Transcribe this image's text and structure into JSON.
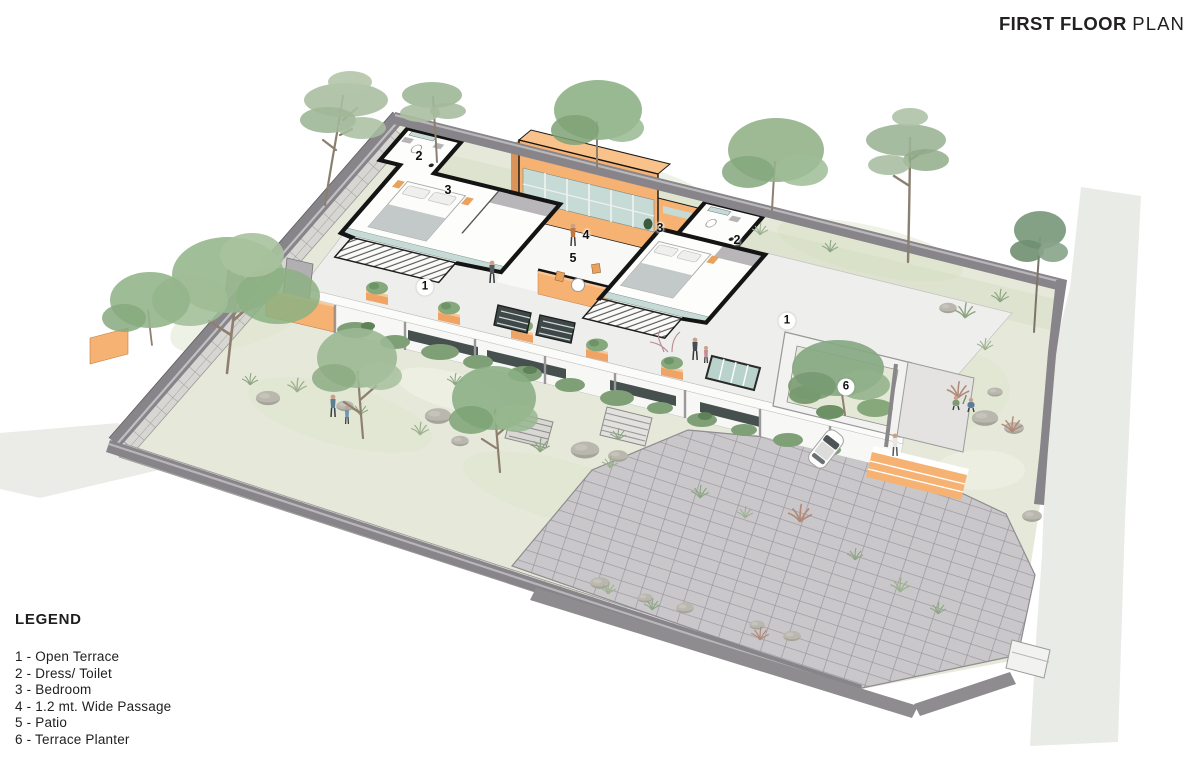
{
  "title": {
    "primary": "FIRST FLOOR",
    "secondary": "PLAN"
  },
  "legend": {
    "heading": "LEGEND",
    "items": [
      "1 - Open Terrace",
      "2 - Dress/ Toilet",
      "3 - Bedroom",
      "4 - 1.2 mt. Wide Passage",
      "5 - Patio",
      "6 - Terrace Planter"
    ]
  },
  "plan_labels": {
    "plain": [
      {
        "text": "2",
        "x": 419,
        "y": 156
      },
      {
        "text": "3",
        "x": 448,
        "y": 190
      },
      {
        "text": "4",
        "x": 586,
        "y": 235
      },
      {
        "text": "5",
        "x": 573,
        "y": 258
      },
      {
        "text": "3",
        "x": 660,
        "y": 228
      },
      {
        "text": "2",
        "x": 737,
        "y": 240
      }
    ],
    "circled": [
      {
        "text": "1",
        "x": 425,
        "y": 287
      },
      {
        "text": "1",
        "x": 787,
        "y": 321
      },
      {
        "text": "6",
        "x": 846,
        "y": 387
      }
    ]
  },
  "palette": {
    "accent_orange": "#F5B273",
    "glazing_teal": "#C6DBD6",
    "lawn_green": "#E6E9DA",
    "boundary_wall_gray": "#87848A",
    "paving_gray": "#C9C7CA",
    "ink": "#1E1E1E"
  }
}
